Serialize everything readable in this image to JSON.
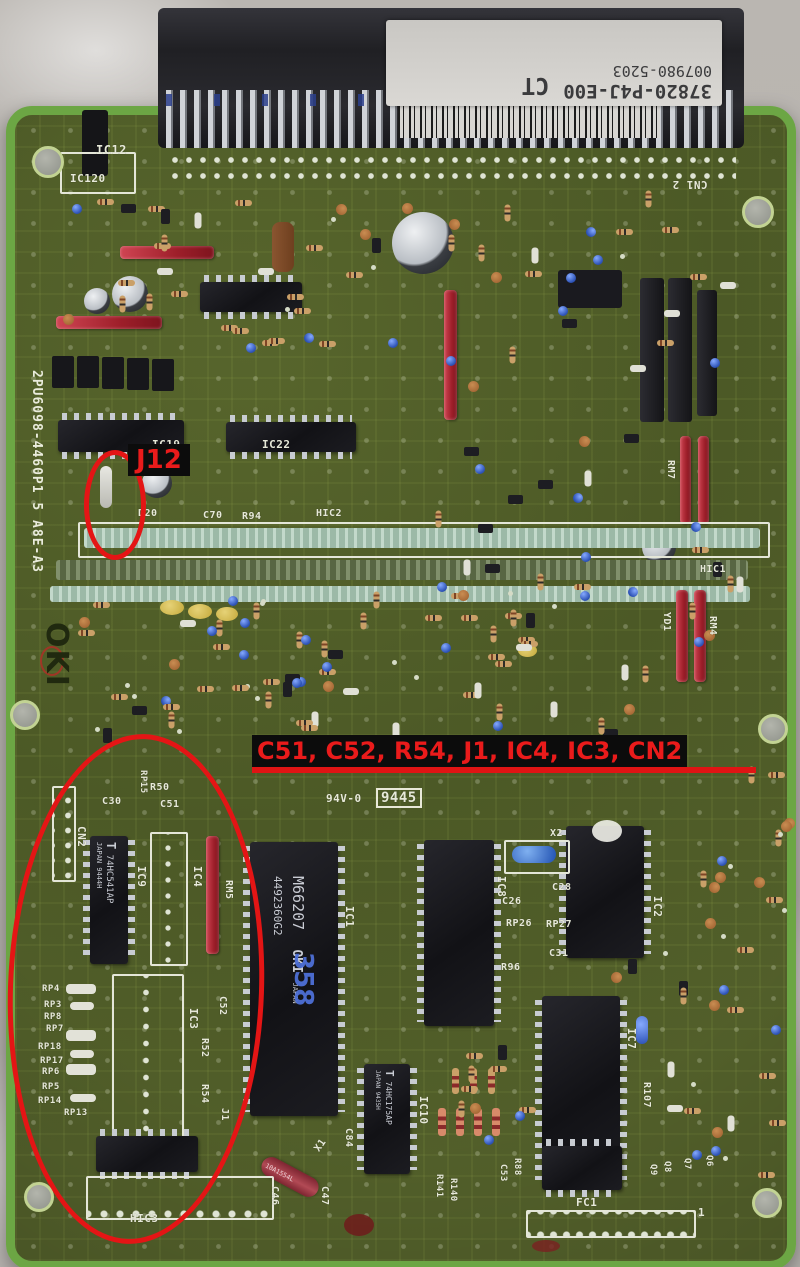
{
  "annotations": {
    "j12_label": "J12",
    "banner": "C51, C52, R54, J1, IC4, IC3, CN2",
    "highlight_color": "#e41515"
  },
  "sticker": {
    "part_number": "37820-P4J-E00",
    "serial": "007980-5203",
    "mark": "CT"
  },
  "board": {
    "maker": "OKI",
    "board_id": "2PU6098-4460P1 5 A8E-A3"
  },
  "chips": {
    "ic9_brand": "T",
    "ic9_part": "74HC541AP",
    "ic9_lot": "JAPAN 9444H",
    "ic1_part": "M66207",
    "ic1_brand": "OKI",
    "ic1_origin": "JAPAN",
    "ic1_lot": "4492360G2",
    "ic1_hand": "358",
    "ic10_brand": "T",
    "ic10_part": "74HC175AP",
    "ic10_lot": "JAPAN 9435H",
    "x1_part": "10A1554L"
  },
  "silk": {
    "ic12": "IC12",
    "ic120": "IC120",
    "cn1": "CN1 2",
    "ic19": "IC19",
    "ic22": "IC22",
    "d20": "D20",
    "c70": "C70",
    "r94": "R94",
    "hic2": "HIC2",
    "hic1": "HIC1",
    "flam": "94V-0",
    "date": "9445",
    "cn2": "CN2",
    "c30": "C30",
    "c51": "C51",
    "r50": "R50",
    "rp15": "RP15",
    "ic9": "IC9",
    "ic4": "IC4",
    "rm5": "RM5",
    "ic1": "IC1",
    "ic8": "IC8",
    "x2": "X2",
    "c28": "C28",
    "c26": "C26",
    "rp26": "RP26",
    "rp27": "RP27",
    "c31": "C31",
    "r96": "R96",
    "ic2": "IC2",
    "ic7": "IC7",
    "r107": "R107",
    "ic3": "IC3",
    "c52": "C52",
    "r52": "R52",
    "r54": "R54",
    "j1": "J1",
    "rp4": "RP4",
    "rp3": "RP3",
    "rp8": "RP8",
    "rp7": "RP7",
    "rp18": "RP18",
    "rp17": "RP17",
    "rp6": "RP6",
    "rp5": "RP5",
    "rp14": "RP14",
    "rp13": "RP13",
    "ic10": "IC10",
    "c84": "C84",
    "x1": "X1",
    "c46": "C46",
    "c47": "C47",
    "hic3": "HIC3",
    "fc1": "FC1",
    "fc1_pin1": "1",
    "r88": "R88",
    "c53": "C53",
    "r141": "R141",
    "r140": "R140",
    "q9": "Q9",
    "q8": "Q8",
    "q7": "Q7",
    "q6": "Q6",
    "rm7": "RM7",
    "rm4": "RM4",
    "yd1": "YD1"
  }
}
